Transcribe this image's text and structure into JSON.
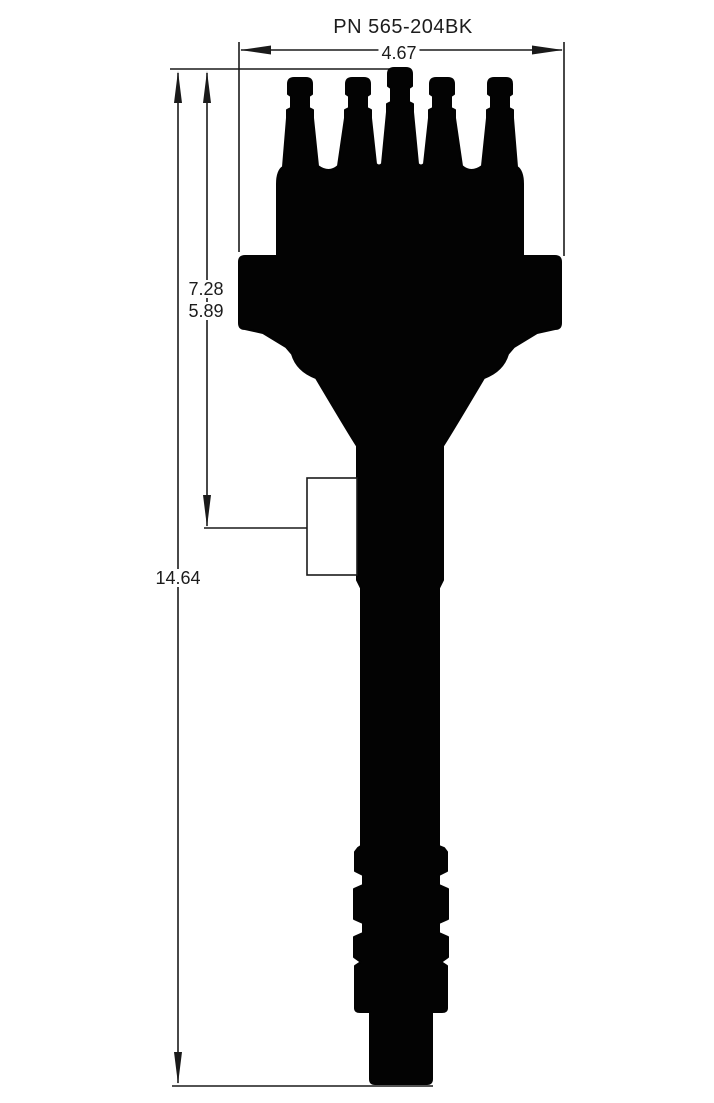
{
  "drawing": {
    "title": "PN 565-204BK",
    "dimensions": {
      "width": "4.67",
      "upper_height": "7.28",
      "clamp_height": "5.89",
      "overall_height": "14.64"
    },
    "figure": {
      "silhouette_name": "distributor-side-profile",
      "clamp_feature_name": "hold-down-clamp-outline"
    },
    "colors": {
      "silhouette": "#030303",
      "line": "#1a1a1a",
      "text": "#1c1c1c",
      "background": "#ffffff"
    }
  }
}
